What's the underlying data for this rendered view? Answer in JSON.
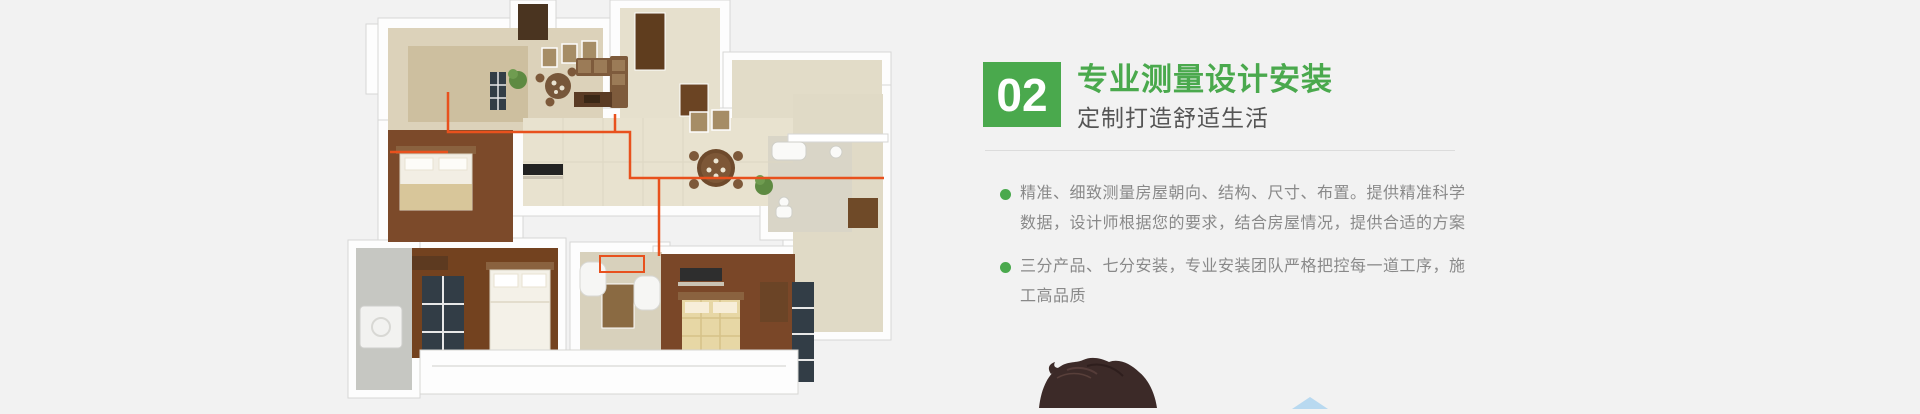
{
  "colors": {
    "background": "#f2f2f2",
    "accent_green": "#4aa94d",
    "subtitle_gray": "#555555",
    "body_gray": "#898989",
    "divider": "#dcdcdc",
    "pipe_orange": "#e8511d",
    "roof_blue": "#b8d9f0",
    "hair_brown": "#3c2a28"
  },
  "content": {
    "badge_number": "02",
    "title": "专业测量设计安装",
    "subtitle": "定制打造舒适生活",
    "bullets": [
      {
        "lines": [
          "精准、细致测量房屋朝向、结构、尺寸、布置。提供精准科学",
          "数据，设计师根据您的要求，结合房屋情况，提供合适的方案"
        ]
      },
      {
        "lines": [
          "三分产品、七分安装，专业安装团队严格把控每一道工序，施",
          "工高品质"
        ]
      }
    ]
  },
  "images": {
    "floorplan": "isometric-3d-apartment-floorplan-with-orange-pipe-routing",
    "person": "top-of-person-head-dark-hair",
    "roof": "light-blue-roof-tip"
  }
}
